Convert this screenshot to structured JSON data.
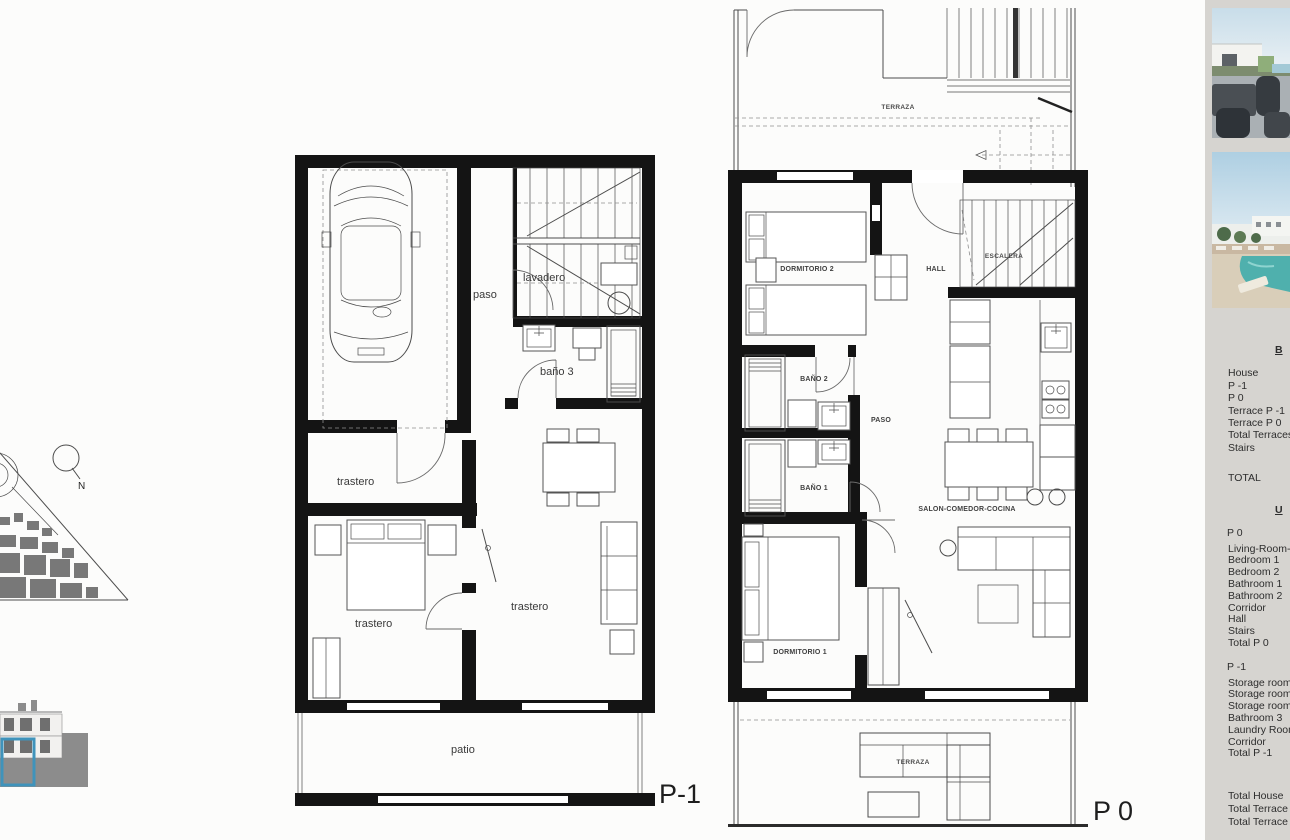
{
  "plans": {
    "p1": {
      "floor_label": "P-1",
      "rooms": {
        "paso": "paso",
        "lavadero": "lavadero",
        "bano3": "baño 3",
        "trastero_top": "trastero",
        "trastero_left": "trastero",
        "trastero_right": "trastero",
        "patio": "patio"
      }
    },
    "p0": {
      "floor_label": "P 0",
      "rooms": {
        "terraza_top": "TERRAZA",
        "dormitorio2": "DORMITORIO 2",
        "hall": "HALL",
        "escalera": "ESCALERA",
        "bano2": "BAÑO 2",
        "paso": "PASO",
        "bano1": "BAÑO 1",
        "salon": "SALON-COMEDOR-COCINA",
        "dormitorio1": "DORMITORIO 1",
        "terraza_bottom": "TERRAZA"
      }
    }
  },
  "site": {
    "north_label": "N"
  },
  "sidebar": {
    "built": {
      "header": "B",
      "rows": [
        "House",
        "P -1",
        "P 0",
        "Terrace  P -1",
        "Terrace  P 0",
        "Total Terraces",
        "Stairs"
      ],
      "total_label": "TOTAL"
    },
    "useful": {
      "header": "U",
      "p0_header": "P 0",
      "p0_rows": [
        "Living-Room-K",
        "Bedroom 1",
        "Bedroom 2",
        "Bathroom 1",
        "Bathroom 2",
        "Corridor",
        "Hall",
        "Stairs",
        "Total  P 0"
      ],
      "p1_header": "P -1",
      "p1_rows": [
        "Storage room",
        "Storage room",
        "Storage room",
        "Bathroom 3",
        "Laundry Room",
        "Corridor",
        "Total  P -1"
      ],
      "grand_totals": [
        "Total  House",
        "Total  Terrace",
        "Total  Terrace"
      ]
    }
  }
}
